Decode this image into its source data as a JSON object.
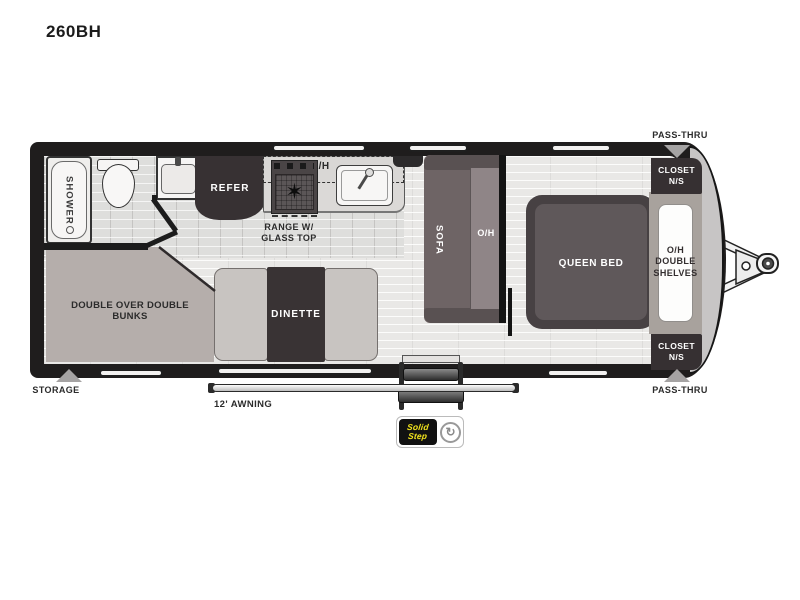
{
  "title": "260BH",
  "colors": {
    "wall": "#1f1d1d",
    "floor": "#e9e8e6",
    "tile": "#dededc",
    "dark_furniture": "#363032",
    "sofa": "#6e6465",
    "bed": "#5f585a",
    "bunk": "#b5aeab",
    "bench": "#c8c4c1",
    "badge_yellow": "#f2e41c",
    "arrow_gray": "#a5a3a3"
  },
  "icons": {
    "burner": "✶",
    "lci_swirl": "↻",
    "storage_arrow": "▲",
    "pass_thru_arrow_top": "▼",
    "pass_thru_arrow_bottom": "▲"
  },
  "floorplan": {
    "bathroom": {
      "shower": "SHOWER"
    },
    "kitchen": {
      "refer": "REFER",
      "overhead": "O/H",
      "range_line1": "RANGE W/",
      "range_line2": "GLASS TOP"
    },
    "living": {
      "sofa": "SOFA",
      "sofa_overhead": "O/H",
      "dinette": "DINETTE"
    },
    "bunks": {
      "line1": "DOUBLE OVER DOUBLE",
      "line2": "BUNKS"
    },
    "bedroom": {
      "bed": "QUEEN BED",
      "shelves_line1": "O/H",
      "shelves_line2": "DOUBLE",
      "shelves_line3": "SHELVES",
      "closet_top_line1": "CLOSET",
      "closet_top_line2": "N/S",
      "closet_bottom_line1": "CLOSET",
      "closet_bottom_line2": "N/S"
    },
    "exterior": {
      "storage": "STORAGE",
      "awning": "12' AWNING",
      "pass_thru_top": "PASS-THRU",
      "pass_thru_bottom": "PASS-THRU"
    },
    "badge": {
      "line1": "Solid",
      "line2": "Step"
    }
  }
}
